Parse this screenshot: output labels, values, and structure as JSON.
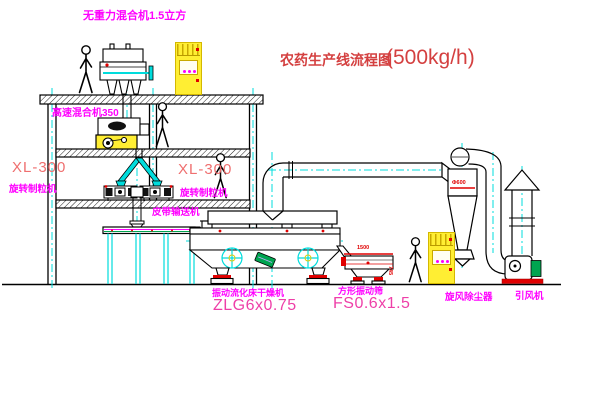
{
  "title": {
    "name": "农药生产线流程图",
    "capacity": "(500kg/h)"
  },
  "equipment": {
    "gravity_mixer": "无重力混合机1.5立方",
    "high_speed_mixer": "高速混合机350",
    "granulator_left": {
      "model": "XL-300",
      "name": "旋转制粒机"
    },
    "granulator_right": {
      "model": "XL-300",
      "name": "旋转制粒机"
    },
    "belt_conveyor": "皮带输送机",
    "fluid_bed_dryer": {
      "name": "振动流化床干燥机",
      "model": "ZLG6x0.75"
    },
    "vibrating_screen": {
      "name": "方形振动筛",
      "model": "FS0.6x1.5"
    },
    "cyclone": "旋风除尘器",
    "induced_draft_fan": "引风机"
  },
  "dimensions": {
    "cyclone_dia": "Φ600",
    "screen_length": "1500",
    "screen_height": "745"
  },
  "colors": {
    "label_magenta": "#ff00ff",
    "title_red": "#d44040",
    "model_red": "#ef6f6f",
    "model_pink": "#ee3fa8",
    "cad_cyan": "#00dcdc",
    "cabinet_yellow": "#ffee33",
    "accent_red": "#e00000",
    "motor_green": "#00a550"
  }
}
